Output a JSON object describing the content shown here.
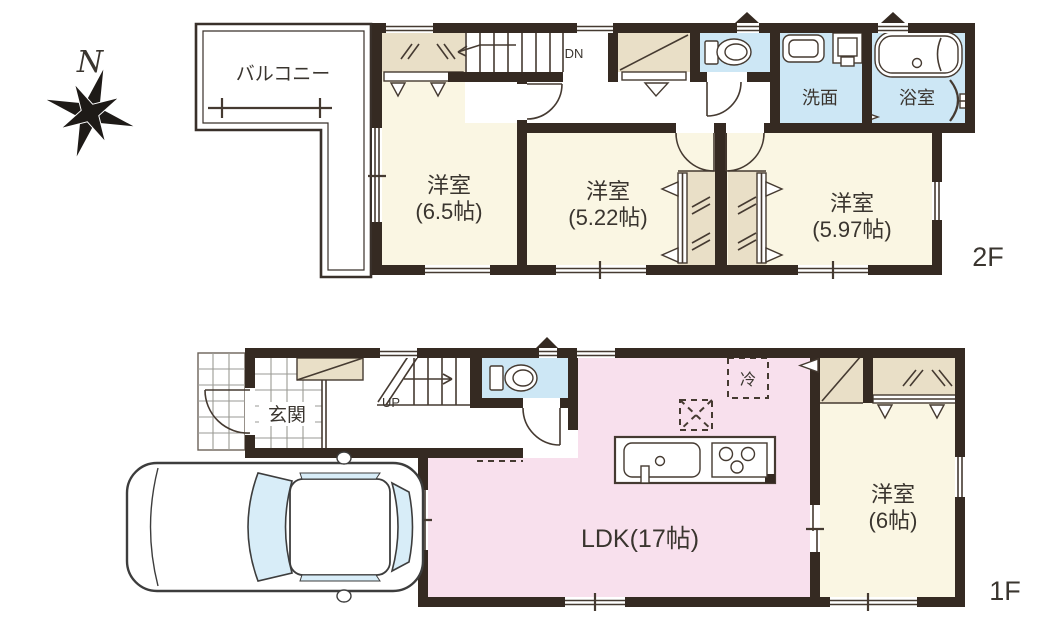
{
  "palette": {
    "wall": "#352a22",
    "room_cream": "#faf6e3",
    "wet_blue": "#cde7f5",
    "ldk_pink": "#f8e0ed",
    "closet_beige": "#e9dfc7",
    "car_glass": "#d8edf8"
  },
  "compass": {
    "north": "N"
  },
  "floor2": {
    "floor_label": "2F",
    "balcony": "バルコニー",
    "stairs": "DN",
    "washroom": "洗面",
    "bathroom": "浴室",
    "rooms": [
      {
        "name": "洋室",
        "size": "(6.5帖)"
      },
      {
        "name": "洋室",
        "size": "(5.22帖)"
      },
      {
        "name": "洋室",
        "size": "(5.97帖)"
      }
    ]
  },
  "floor1": {
    "floor_label": "1F",
    "entrance": "玄関",
    "stairs": "UP",
    "refrigerator": "冷",
    "ldk": "LDK(17帖)",
    "room": {
      "name": "洋室",
      "size": "(6帖)"
    }
  }
}
